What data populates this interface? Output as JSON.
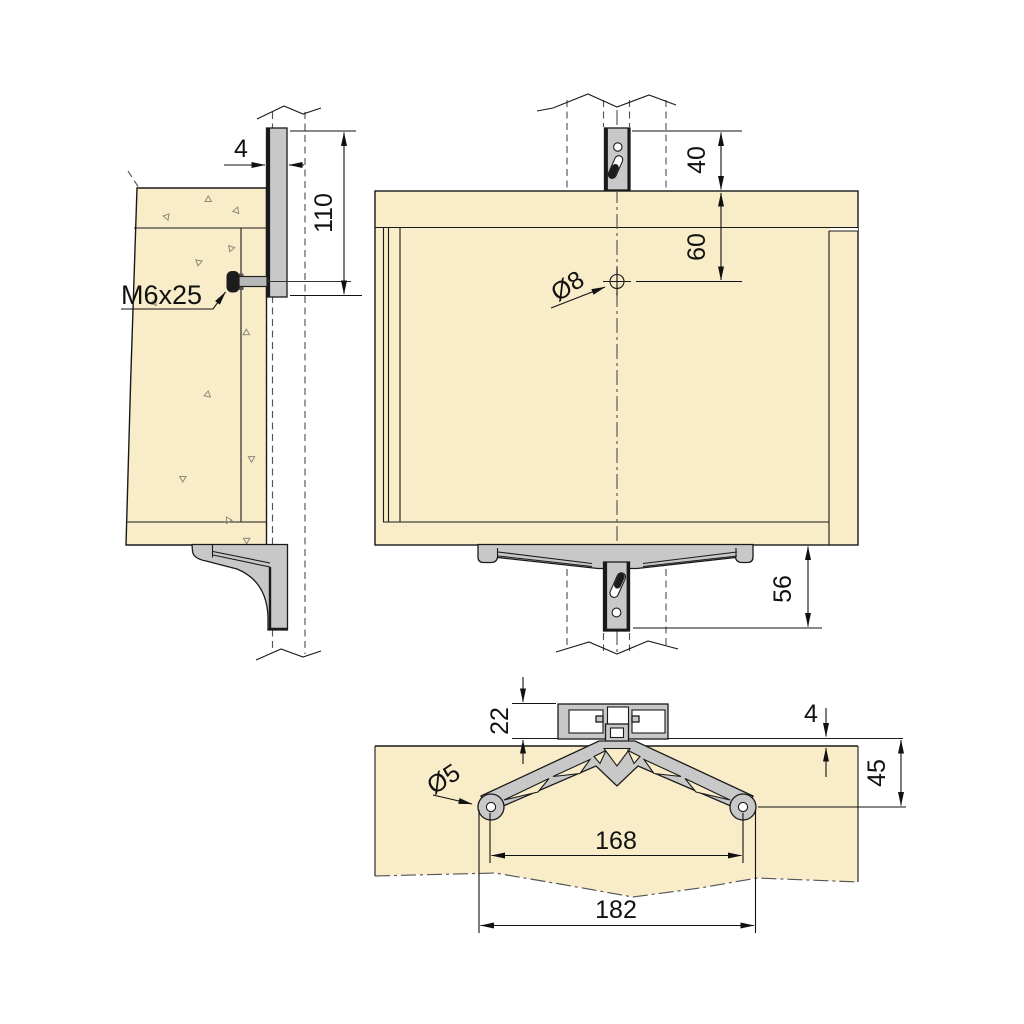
{
  "drawing": {
    "side_view": {
      "thickness_label": "4",
      "height_label": "110",
      "screw_label": "M6x25"
    },
    "front_view": {
      "top_gap_label": "40",
      "hole_down_label": "60",
      "hole_dia_label": "Ø8",
      "drop_label": "56"
    },
    "section_view": {
      "profile_label": "22",
      "proud_label": "4",
      "depth_label": "45",
      "hole_dia_label": "Ø5",
      "spacing_label": "168",
      "width_label": "182"
    }
  },
  "colors": {
    "wood": "#f9ecc9",
    "metal": "#c8c8c8",
    "line": "#1a1a1a",
    "hidden": "#555555",
    "dim": "#111111",
    "screw": "#1c1c1c",
    "background": "#ffffff"
  }
}
